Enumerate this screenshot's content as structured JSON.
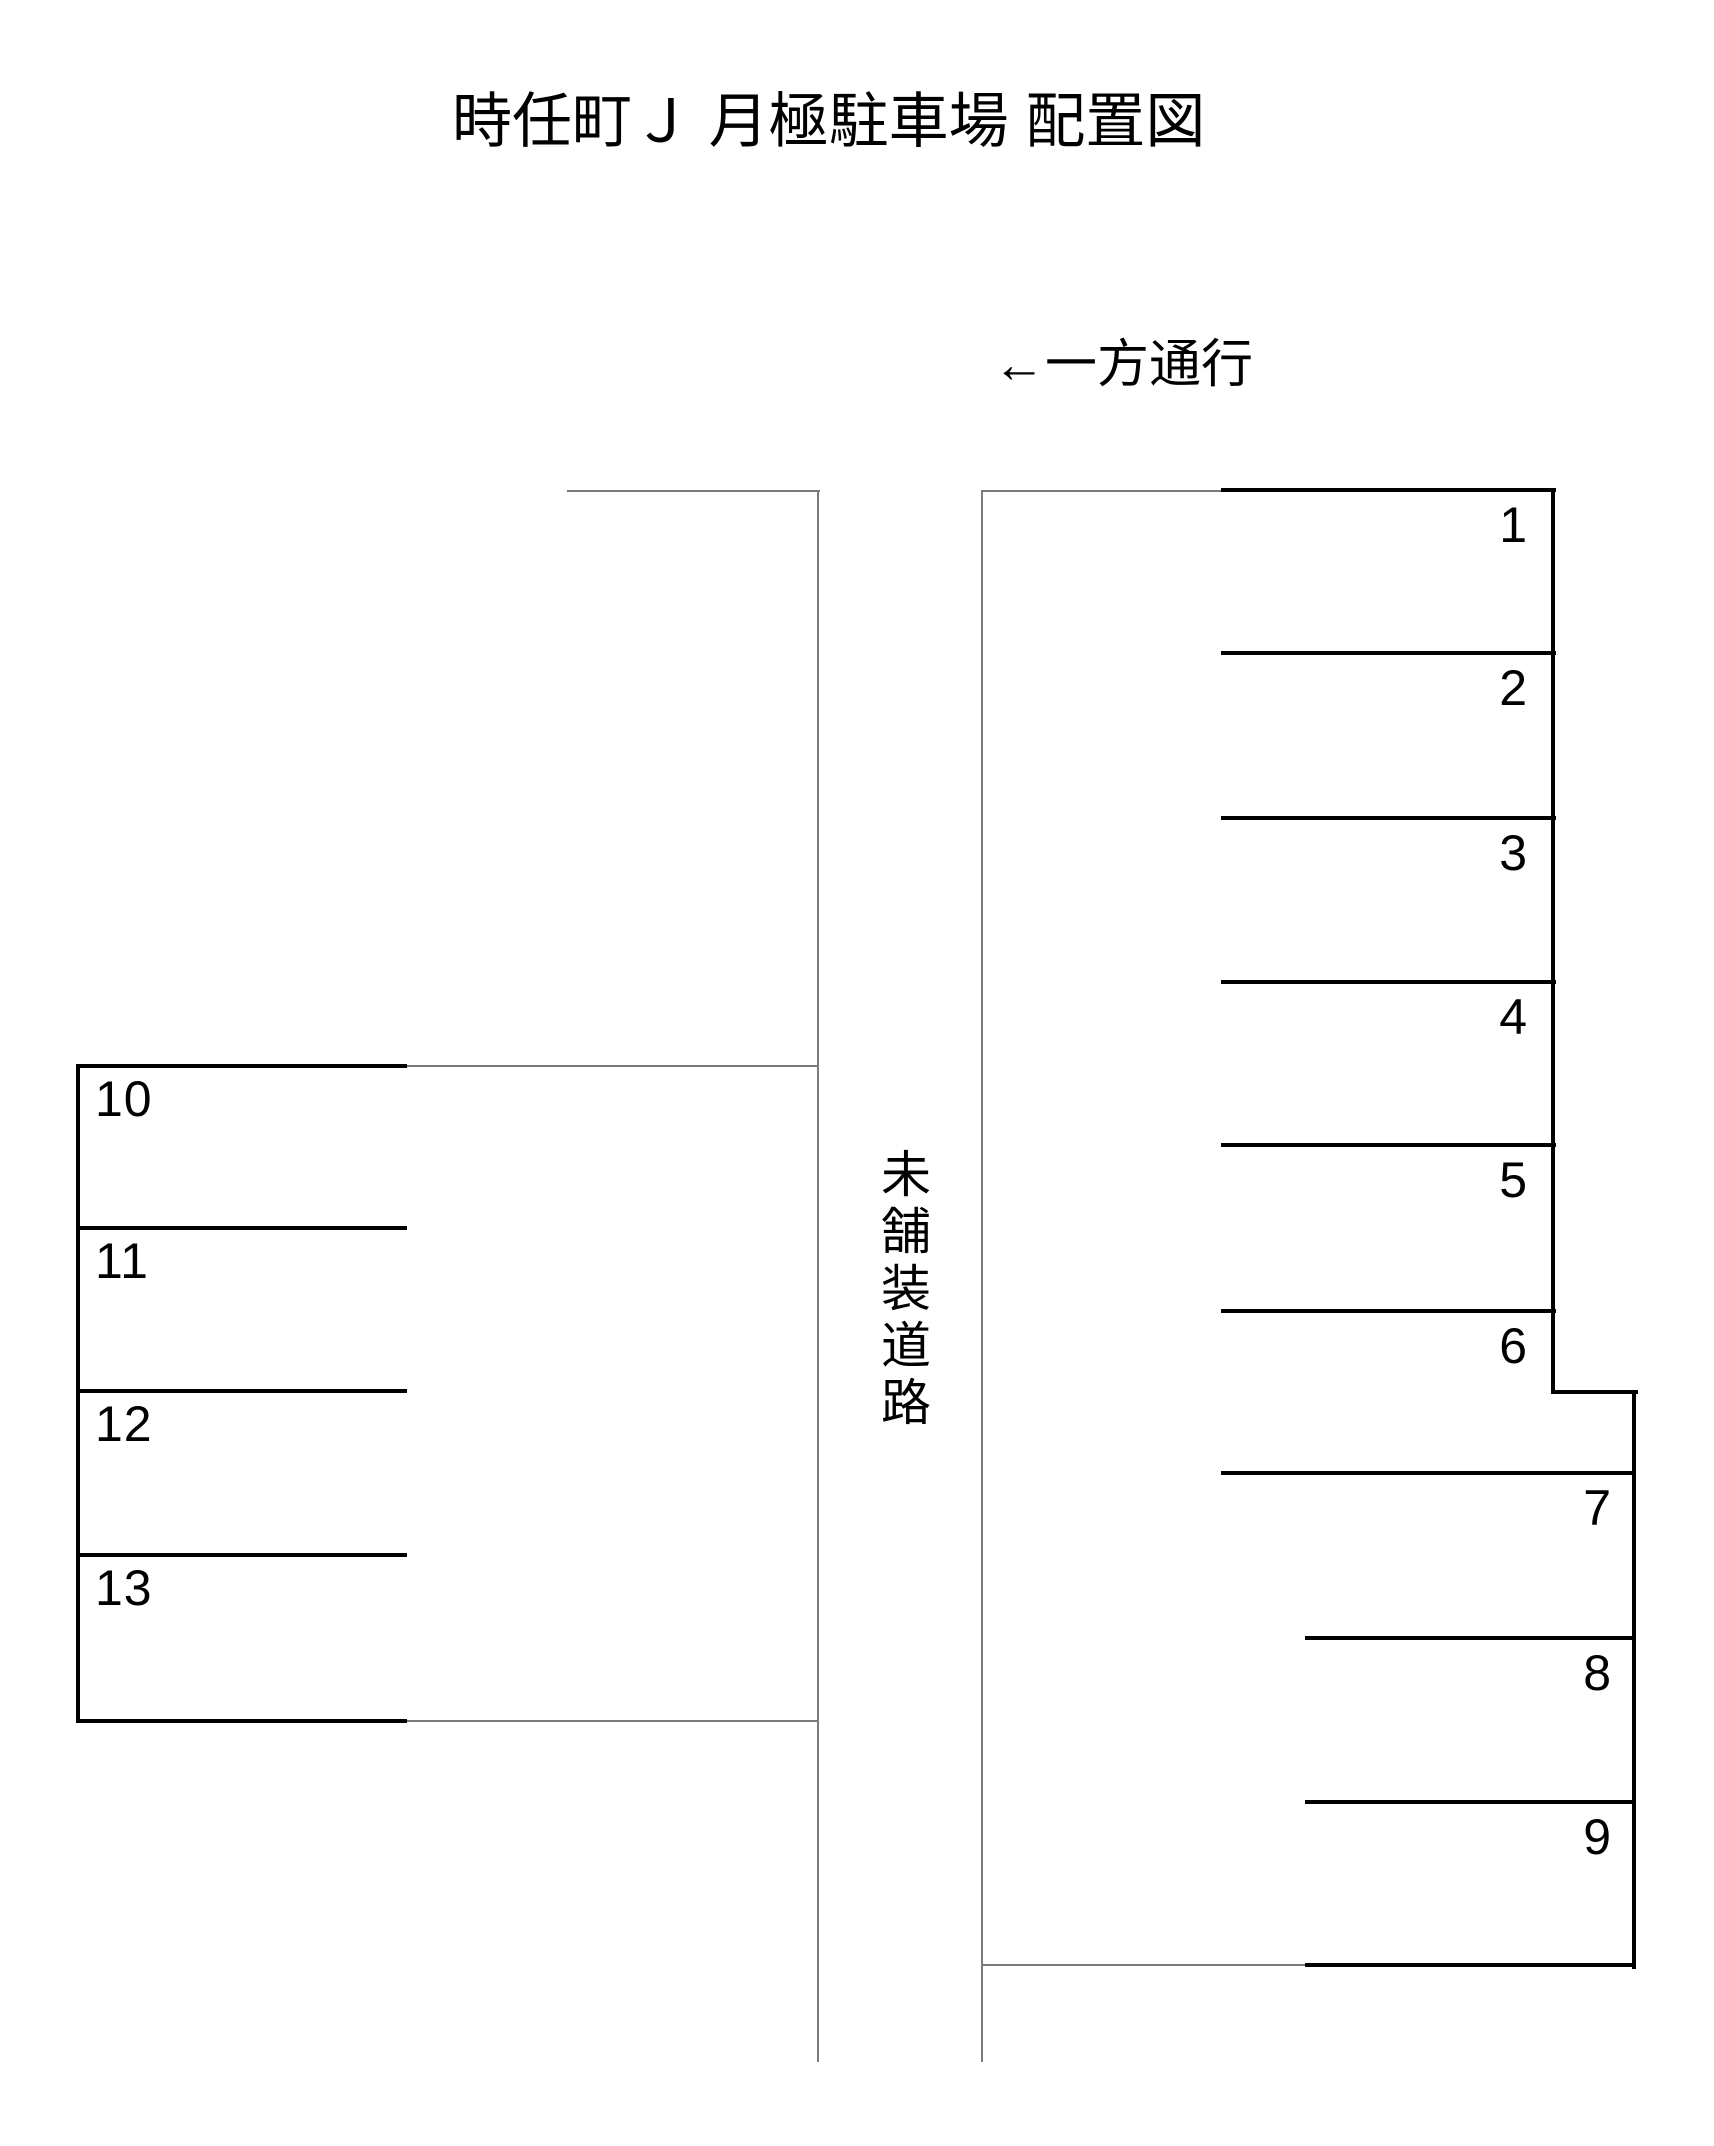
{
  "title": "時任町Ｊ 月極駐車場 配置図",
  "one_way": {
    "arrow": "←",
    "text": "一方通行"
  },
  "road": {
    "label": "未舗装道路"
  },
  "stalls": {
    "right": [
      "1",
      "2",
      "3",
      "4",
      "5",
      "6",
      "7",
      "8",
      "9"
    ],
    "left": [
      "10",
      "11",
      "12",
      "13"
    ]
  },
  "colors": {
    "background": "#ffffff",
    "line_thick": "#000000",
    "line_thin": "#7b7b7b",
    "text": "#000000"
  }
}
